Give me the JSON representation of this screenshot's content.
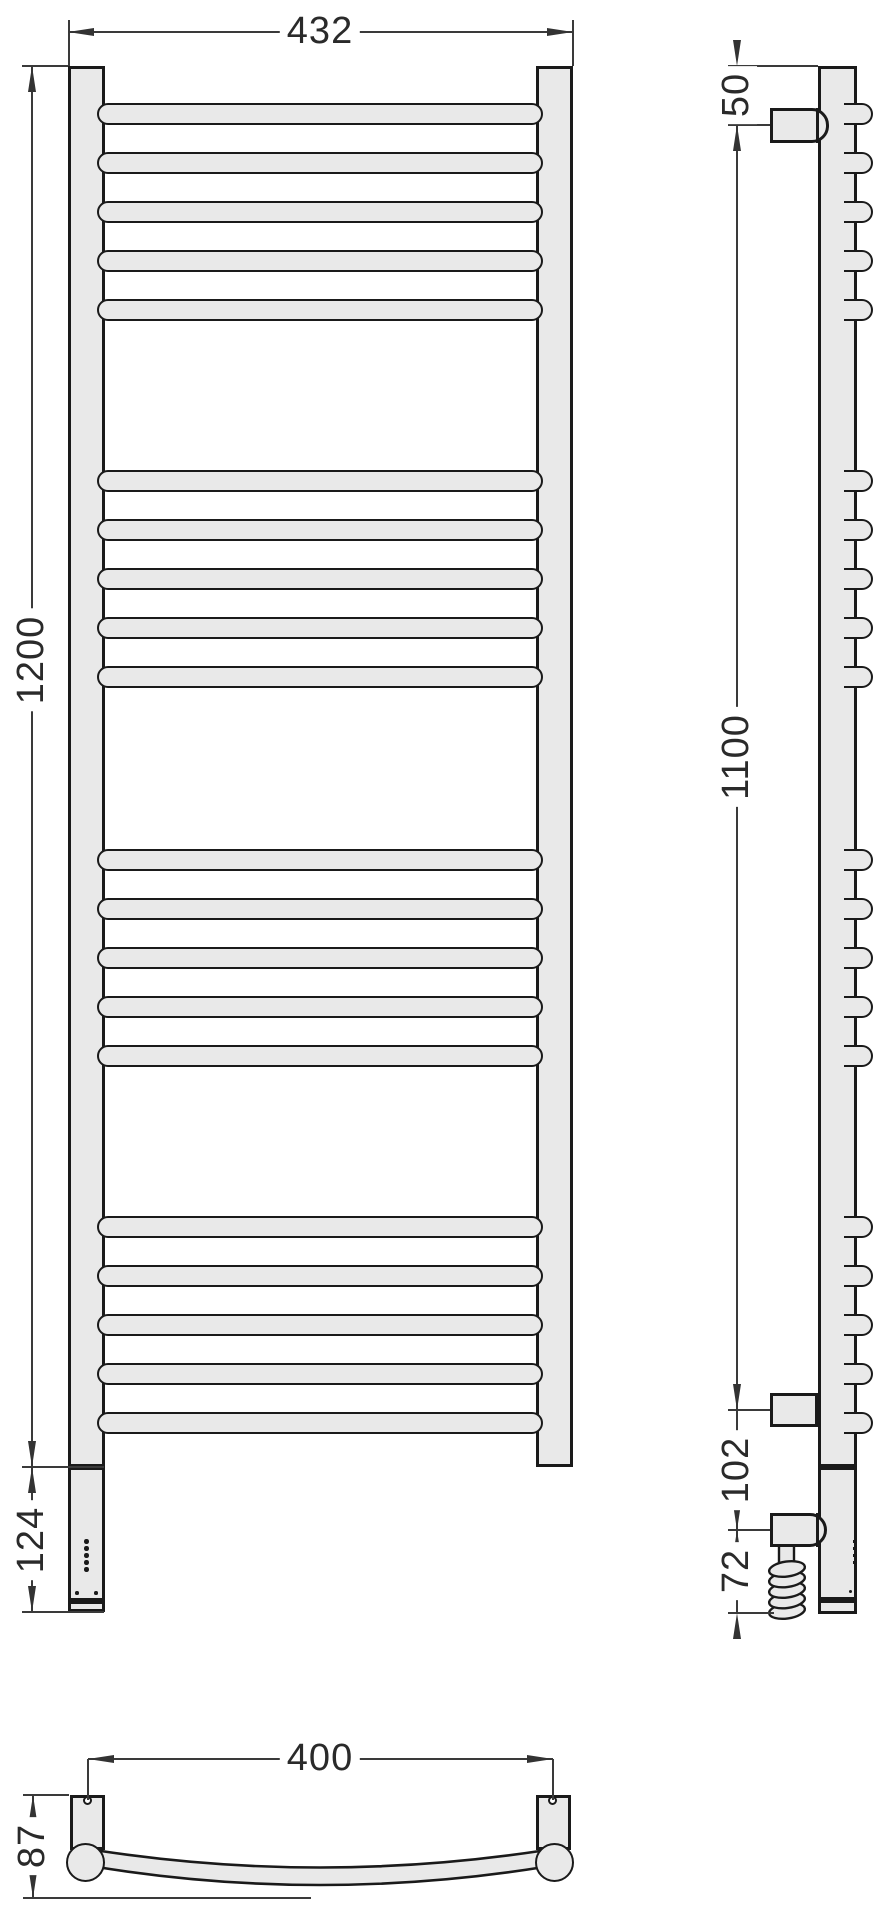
{
  "drawing": {
    "kind": "towel-rail technical drawing",
    "views": [
      "front",
      "side",
      "top"
    ]
  },
  "dimensions": {
    "overall_width_mm": "432",
    "overall_height_mm": "1200",
    "heating_unit_length_mm": "124",
    "top_bracket_offset_mm": "50",
    "bracket_span_mm": "1100",
    "bracket_to_cable_mm": "102",
    "cable_drop_mm": "72",
    "bracket_spacing_mm": "400",
    "depth_mm": "87"
  },
  "structure": {
    "rung_groups": 4,
    "rungs_per_group": 5,
    "total_rungs": 20,
    "indicator_dot_count": 5,
    "lower_dot_count": 2,
    "cable_coil_turns": 5
  },
  "colors": {
    "part_fill": "#e9e9e9",
    "part_stroke": "#1a1a1a",
    "dimension_line": "#3a3a3a",
    "background": "#ffffff"
  }
}
